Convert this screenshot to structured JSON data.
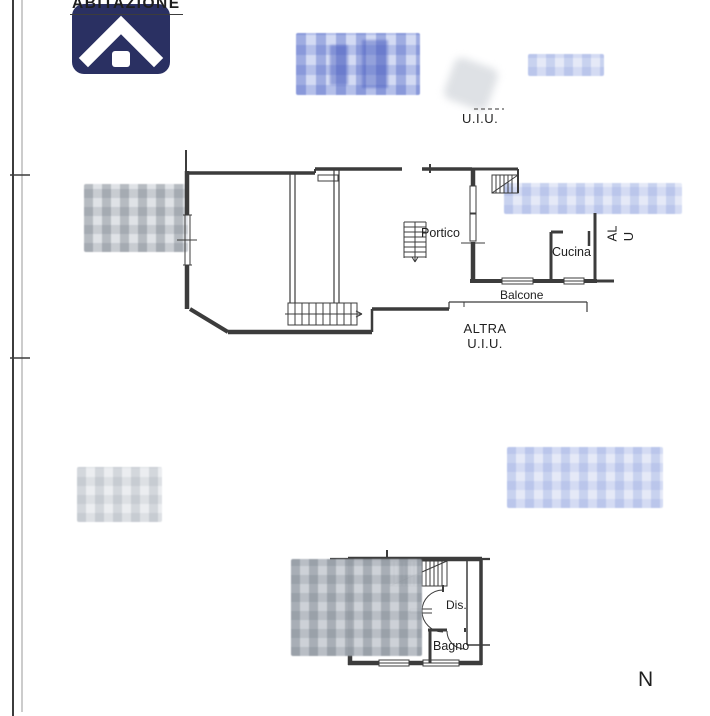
{
  "document": {
    "header_label": "ABITAZIONE",
    "north_label": "N"
  },
  "upper_plan": {
    "unit_label_top": "U.I.U.",
    "rooms": {
      "portico": "Portico",
      "cucina": "Cucina",
      "balcone": "Balcone"
    },
    "adjacent_unit": {
      "line1": "ALTRA",
      "line2": "U.I.U."
    },
    "adjacent_unit_right": {
      "line1": "AL",
      "line2": "U"
    }
  },
  "lower_plan": {
    "rooms": {
      "dis": "Dis.",
      "bagno": "Bagno"
    }
  },
  "watermarks": {
    "logo_icon": "house-logo",
    "privacy_blurs": "pixelated-redaction-patches"
  },
  "colors": {
    "logo_background": "#2a3062",
    "plan_lines": "#3c3c3c",
    "blur_gray": "#b9bfc7",
    "blur_blue": "#8b9cdc"
  }
}
